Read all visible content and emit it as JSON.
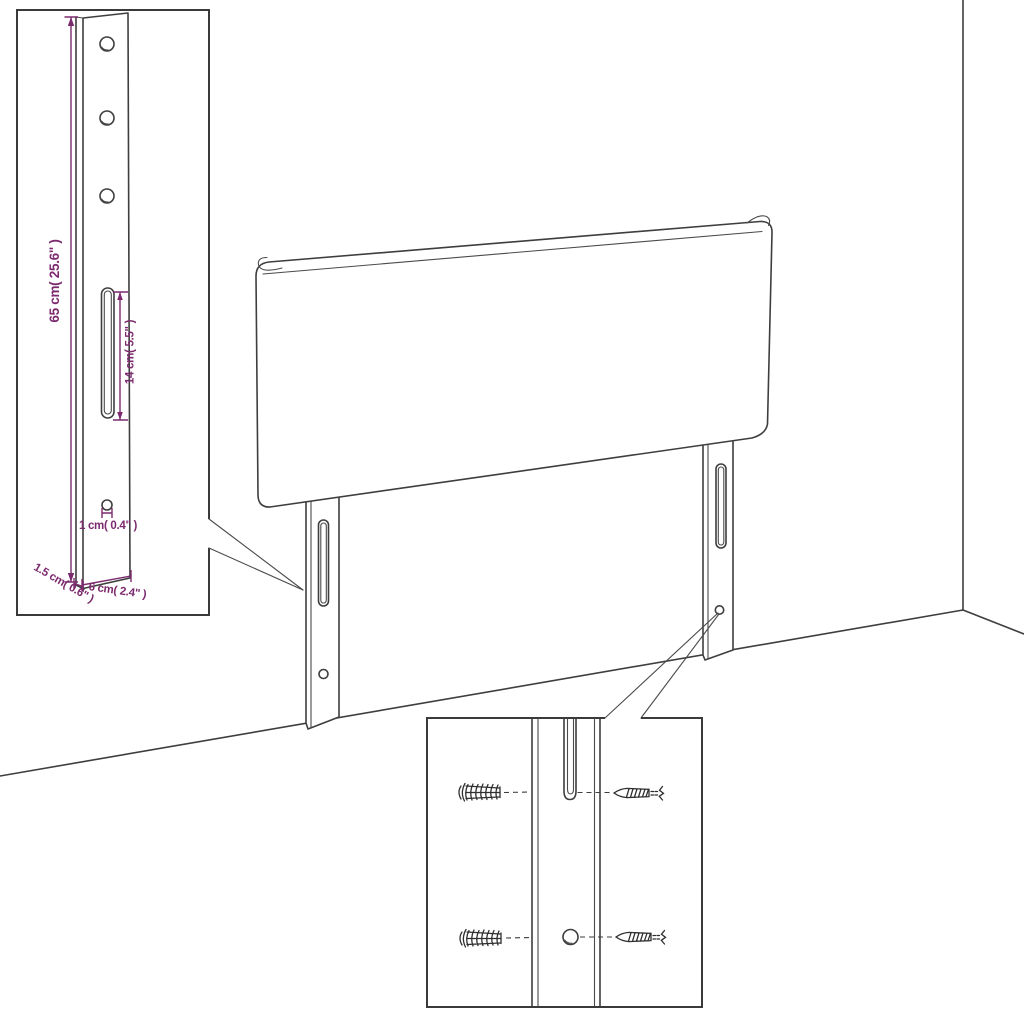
{
  "diagram": {
    "subject": "headboard-mounting-diagram",
    "colors": {
      "background": "#ffffff",
      "line": "#3e3e3e",
      "dimension": "#7c2a6e"
    },
    "dimensions": {
      "bracket_height": "65 cm( 25.6\" )",
      "slot_length": "14 cm( 5.5\" )",
      "hole_diameter": "1 cm( 0.4\" )",
      "bracket_depth": "1.5 cm( 0.6\" )",
      "bracket_width": "6 cm( 2.4\" )"
    }
  }
}
